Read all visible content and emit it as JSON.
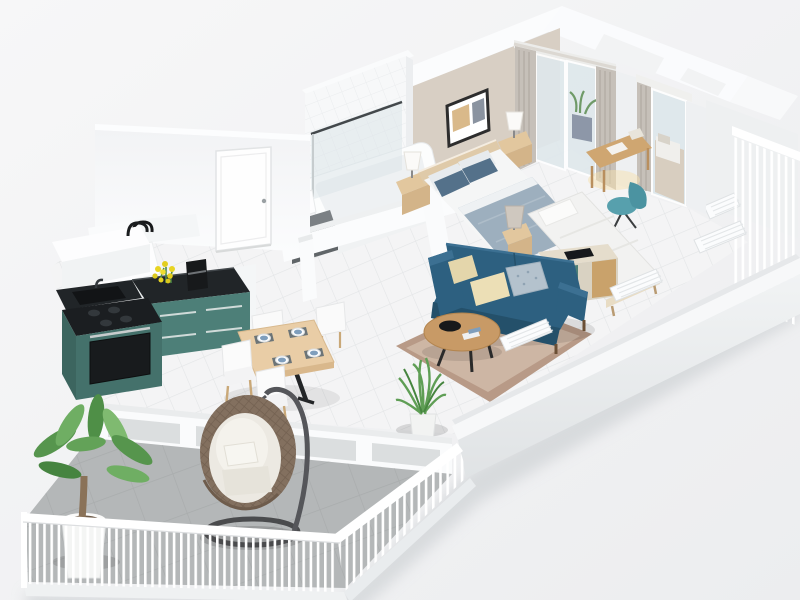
{
  "meta": {
    "type": "3d-floorplan-render",
    "view": "axonometric-cutaway",
    "description": "Photoreal 3D cutaway floor plan of a two-bedroom apartment with wrap-around balcony",
    "visible_text": ""
  },
  "palette": {
    "background_start": "#f7f7f8",
    "background_end": "#ecedef",
    "shadow": "#d2d5d8",
    "wall_white": "#fbfcfd",
    "wall_face": "#f1f2f4",
    "wall_beige": "#d8cfc4",
    "floor_tile": "#f4f4f5",
    "balcony_floor": "#b4b7b8",
    "railing": "#ffffff",
    "cabinet_teal": "#4d7f78",
    "cabinet_teal_dark": "#44716b",
    "countertop_black": "#212528",
    "sofa_teal": "#2d6080",
    "sofa_dark": "#24506a",
    "pillow_cream": "#ecdfb6",
    "pillow_pattern": "#b4c2cd",
    "rug_border": "#b89a87",
    "rug_field": "#cdb6a4",
    "wood_light": "#e9cda6",
    "wood_mid": "#c89a66",
    "bed_blanket": "#9dafbe",
    "bed_pillow_blue": "#54718a",
    "linen_white": "#f5f6f6",
    "plant_green": "#5f9e55",
    "rattan": "#83705f",
    "curtain": "#c6c0b9",
    "desk_chair_teal": "#57a0ad",
    "glass": "#dfe8ec",
    "flower_yellow": "#e8d422",
    "radiator": "#fbfcfd"
  },
  "rooms": [
    {
      "name": "master-bedroom",
      "furniture": [
        "double-bed",
        "headboard",
        "nightstand-left",
        "nightstand-right",
        "table-lamps",
        "wall-picture",
        "sliding-glass-door",
        "curtains"
      ]
    },
    {
      "name": "second-bedroom",
      "furniture": [
        "single-bed",
        "nightstand",
        "table-lamp",
        "desk",
        "desk-chair",
        "glass-door"
      ]
    },
    {
      "name": "bathroom",
      "furniture": [
        "bathtub",
        "glass-shower-screen",
        "sink-shelf",
        "vanity-counter"
      ]
    },
    {
      "name": "hallway",
      "furniture": [
        "entry-door",
        "wc-faucet"
      ]
    },
    {
      "name": "kitchen",
      "furniture": [
        "island-unit",
        "sink-counter",
        "cooktop-oven",
        "coffee-machine",
        "flower-bouquet",
        "white-counter"
      ]
    },
    {
      "name": "dining-area",
      "furniture": [
        "dining-table",
        "white-chairs-x4",
        "place-settings-x4"
      ]
    },
    {
      "name": "living-room",
      "furniture": [
        "teal-sofa",
        "cushions-x3",
        "coffee-table",
        "rug",
        "media-console",
        "potted-plant",
        "radiators-x3"
      ]
    },
    {
      "name": "balcony",
      "furniture": [
        "hanging-egg-chair",
        "palm-plant",
        "white-railing",
        "low-parapet"
      ]
    },
    {
      "name": "right-balcony",
      "furniture": [
        "white-railing",
        "radiator"
      ]
    }
  ]
}
